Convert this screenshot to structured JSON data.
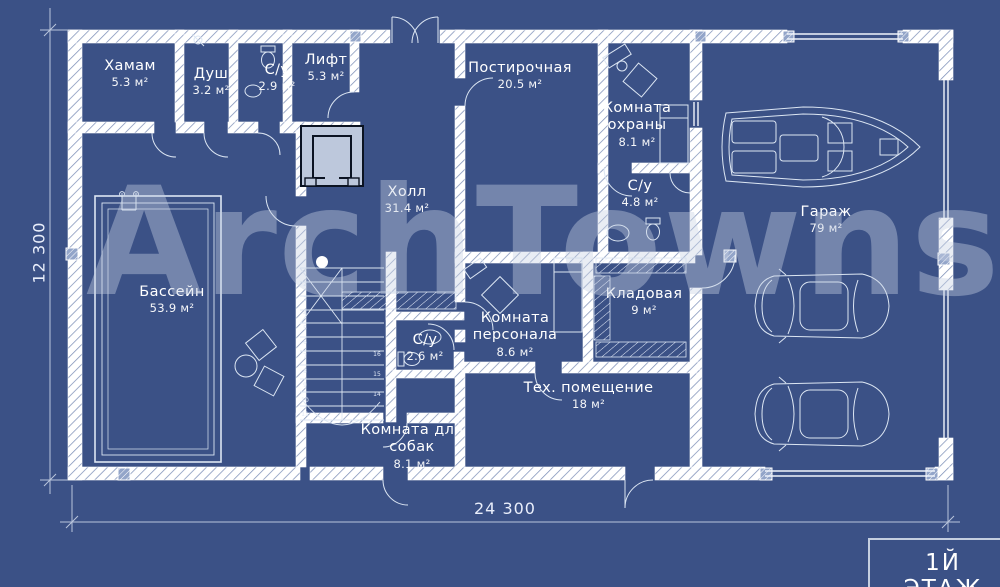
{
  "plan": {
    "watermark": "ArchTowns",
    "floor_label": "1Й ЭТАЖ",
    "dimensions": {
      "bottom": "24 300",
      "left": "12 300"
    },
    "rooms": [
      {
        "name": "Хамам",
        "area": "5.3 м²"
      },
      {
        "name": "Душ",
        "area": "3.2 м²"
      },
      {
        "name": "С/у",
        "area": "2.9 м²"
      },
      {
        "name": "Лифт",
        "area": "5.3 м²"
      },
      {
        "name": "Постирочная",
        "area": "20.5 м²"
      },
      {
        "name": "Комната охраны",
        "area": "8.1 м²"
      },
      {
        "name": "С/у",
        "area": "4.8 м²"
      },
      {
        "name": "Холл",
        "area": "31.4 м²"
      },
      {
        "name": "Бассейн",
        "area": "53.9 м²"
      },
      {
        "name": "Гараж",
        "area": "79 м²"
      },
      {
        "name": "Кладовая",
        "area": "9 м²"
      },
      {
        "name": "Комната персонала",
        "area": "8.6 м²"
      },
      {
        "name": "С/у",
        "area": "2.6 м²"
      },
      {
        "name": "Тех. помещение",
        "area": "18 м²"
      },
      {
        "name": "Комната для собак",
        "area": "8.1 м²"
      }
    ],
    "stairs": {
      "left": [
        "1",
        "2",
        "3",
        "4",
        "5",
        "6",
        "7",
        "8",
        "9",
        "10",
        "11"
      ],
      "right": [
        "16",
        "15",
        "14"
      ]
    },
    "colors": {
      "background": "#3b5186",
      "wall_white": "#ffffff",
      "wall_hatch": "#7e90b8",
      "thin_line": "#dce6f3",
      "watermark": "#cad4e6",
      "lift_shaft_fill": "#bdc8dc"
    }
  }
}
